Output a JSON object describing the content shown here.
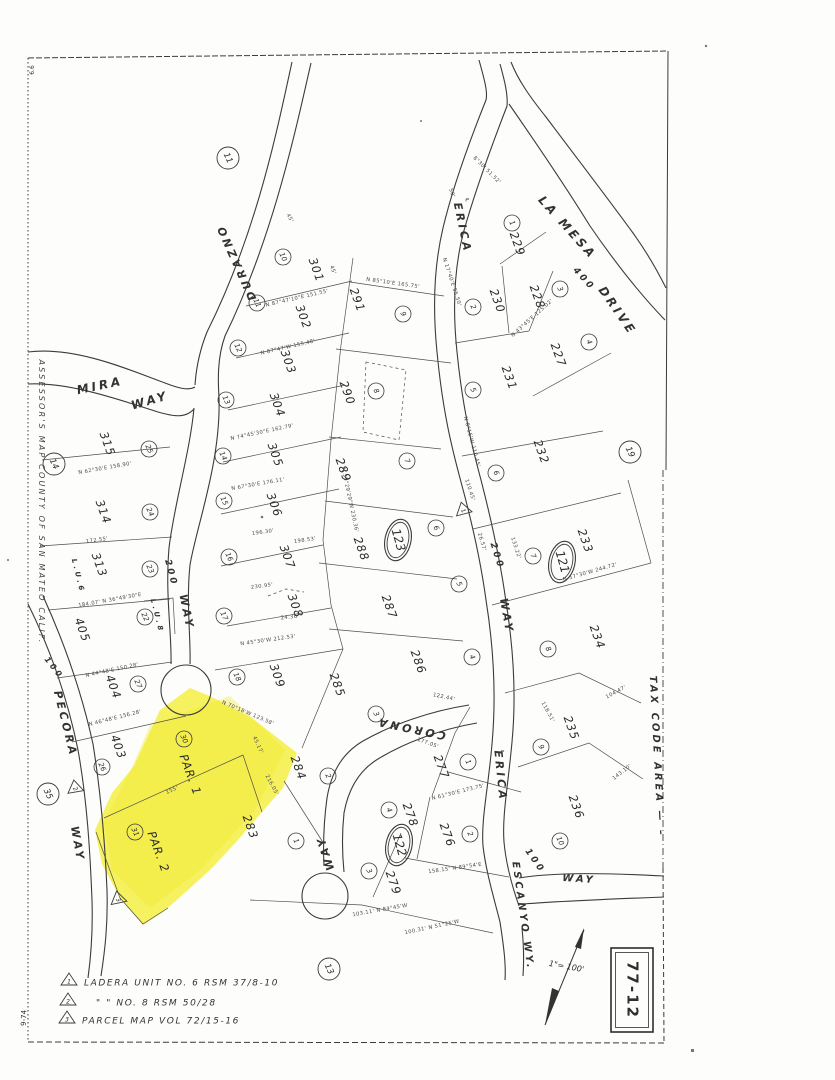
{
  "sheet": {
    "number": "77-12",
    "scale_label": "1\"= 100'",
    "side_title": "ASSESSOR'S  MAP  COUNTY  OF  SAN  MATEO  CALIF.",
    "tax_area_label": "TAX  CODE  AREA — –",
    "corner_mark_top": "6.6",
    "corner_mark_bottom": "9-74",
    "highlight_color": "#f4ee3b",
    "ink_color": "#3b3b3b"
  },
  "legend": {
    "rows": [
      {
        "sym": "1",
        "x": 69,
        "y": 983,
        "tx": 84,
        "text": "LADERA   UNIT   NO. 6   RSM   37/8-10"
      },
      {
        "sym": "2",
        "x": 68,
        "y": 1003,
        "tx": 96,
        "text": "\"          \"          NO. 8   RSM   50/28"
      },
      {
        "sym": "3",
        "x": 67,
        "y": 1021,
        "tx": 82,
        "text": "PARCEL  MAP  VOL  72/15-16"
      }
    ]
  },
  "streets": [
    {
      "t": "MIRA",
      "x": 100,
      "y": 386,
      "r": -12,
      "s": 12
    },
    {
      "t": "WAY",
      "x": 150,
      "y": 401,
      "r": -16,
      "s": 12
    },
    {
      "t": "DURAZNO",
      "x": 237,
      "y": 262,
      "r": 246,
      "s": 11
    },
    {
      "t": "200",
      "x": 171,
      "y": 573,
      "r": 75,
      "s": 9
    },
    {
      "t": "WAY",
      "x": 186,
      "y": 612,
      "r": 78,
      "s": 11
    },
    {
      "t": "LA  MESA",
      "x": 567,
      "y": 228,
      "r": 48,
      "s": 12
    },
    {
      "t": "DRIVE",
      "x": 617,
      "y": 311,
      "r": 55,
      "s": 12
    },
    {
      "t": "400",
      "x": 584,
      "y": 279,
      "r": 48,
      "s": 9
    },
    {
      "t": "ERICA",
      "x": 462,
      "y": 228,
      "r": 78,
      "s": 11
    },
    {
      "t": "200",
      "x": 497,
      "y": 556,
      "r": 72,
      "s": 9
    },
    {
      "t": "WAY",
      "x": 506,
      "y": 616,
      "r": 80,
      "s": 11
    },
    {
      "t": "ERICA",
      "x": 500,
      "y": 776,
      "r": 84,
      "s": 11
    },
    {
      "t": "100",
      "x": 535,
      "y": 861,
      "r": 55,
      "s": 9
    },
    {
      "t": "CORONA",
      "x": 411,
      "y": 728,
      "r": 192,
      "s": 11
    },
    {
      "t": "WAY",
      "x": 326,
      "y": 853,
      "r": 252,
      "s": 11
    },
    {
      "t": "ESCANYO  WY.",
      "x": 523,
      "y": 916,
      "r": 82,
      "s": 10
    },
    {
      "t": "WAY",
      "x": 579,
      "y": 879,
      "r": 4,
      "s": 10
    },
    {
      "t": "PECORA",
      "x": 65,
      "y": 724,
      "r": 76,
      "s": 11
    },
    {
      "t": "WAY",
      "x": 77,
      "y": 844,
      "r": 80,
      "s": 11
    },
    {
      "t": "100",
      "x": 54,
      "y": 668,
      "r": 52,
      "s": 8
    },
    {
      "t": "L.U.6",
      "x": 78,
      "y": 576,
      "r": 76,
      "s": 7
    },
    {
      "t": "L.U.8",
      "x": 157,
      "y": 616,
      "r": 76,
      "s": 7
    }
  ],
  "lots": [
    {
      "t": "301",
      "x": 316,
      "y": 270
    },
    {
      "t": "302",
      "x": 303,
      "y": 317
    },
    {
      "t": "303",
      "x": 288,
      "y": 362
    },
    {
      "t": "304",
      "x": 277,
      "y": 405
    },
    {
      "t": "305",
      "x": 275,
      "y": 455
    },
    {
      "t": "306",
      "x": 274,
      "y": 505
    },
    {
      "t": "307",
      "x": 287,
      "y": 557
    },
    {
      "t": "308",
      "x": 295,
      "y": 606
    },
    {
      "t": "309",
      "x": 277,
      "y": 676
    },
    {
      "t": "291",
      "x": 357,
      "y": 300
    },
    {
      "t": "290",
      "x": 347,
      "y": 393
    },
    {
      "t": "289",
      "x": 343,
      "y": 470
    },
    {
      "t": "288",
      "x": 361,
      "y": 549
    },
    {
      "t": "287",
      "x": 389,
      "y": 607
    },
    {
      "t": "286",
      "x": 418,
      "y": 662
    },
    {
      "t": "285",
      "x": 337,
      "y": 685
    },
    {
      "t": "284",
      "x": 298,
      "y": 768
    },
    {
      "t": "283",
      "x": 250,
      "y": 827
    },
    {
      "t": "277",
      "x": 441,
      "y": 767
    },
    {
      "t": "278",
      "x": 410,
      "y": 815
    },
    {
      "t": "276",
      "x": 447,
      "y": 835
    },
    {
      "t": "279",
      "x": 393,
      "y": 883
    },
    {
      "t": "229",
      "x": 517,
      "y": 244
    },
    {
      "t": "230",
      "x": 497,
      "y": 301
    },
    {
      "t": "228",
      "x": 537,
      "y": 297
    },
    {
      "t": "227",
      "x": 558,
      "y": 355
    },
    {
      "t": "231",
      "x": 509,
      "y": 378
    },
    {
      "t": "232",
      "x": 541,
      "y": 452
    },
    {
      "t": "233",
      "x": 585,
      "y": 541
    },
    {
      "t": "234",
      "x": 597,
      "y": 637
    },
    {
      "t": "235",
      "x": 571,
      "y": 728
    },
    {
      "t": "236",
      "x": 576,
      "y": 807
    },
    {
      "t": "315",
      "x": 107,
      "y": 444
    },
    {
      "t": "314",
      "x": 103,
      "y": 512
    },
    {
      "t": "313",
      "x": 99,
      "y": 565
    },
    {
      "t": "405",
      "x": 82,
      "y": 630
    },
    {
      "t": "404",
      "x": 113,
      "y": 687
    },
    {
      "t": "403",
      "x": 118,
      "y": 747
    },
    {
      "t": "PAR.  1",
      "x": 190,
      "y": 775
    },
    {
      "t": "PAR.  2",
      "x": 158,
      "y": 852
    }
  ],
  "circles": [
    {
      "n": "10",
      "x": 283,
      "y": 257
    },
    {
      "n": "11",
      "x": 257,
      "y": 303
    },
    {
      "n": "12",
      "x": 238,
      "y": 348
    },
    {
      "n": "13",
      "x": 226,
      "y": 400
    },
    {
      "n": "14",
      "x": 223,
      "y": 456
    },
    {
      "n": "15",
      "x": 224,
      "y": 501
    },
    {
      "n": "16",
      "x": 229,
      "y": 557
    },
    {
      "n": "17",
      "x": 224,
      "y": 616
    },
    {
      "n": "18",
      "x": 237,
      "y": 677
    },
    {
      "n": "9",
      "x": 403,
      "y": 314
    },
    {
      "n": "8",
      "x": 376,
      "y": 391
    },
    {
      "n": "7",
      "x": 407,
      "y": 461
    },
    {
      "n": "6",
      "x": 436,
      "y": 528
    },
    {
      "n": "5",
      "x": 459,
      "y": 584
    },
    {
      "n": "4",
      "x": 472,
      "y": 657
    },
    {
      "n": "3",
      "x": 376,
      "y": 714
    },
    {
      "n": "2",
      "x": 328,
      "y": 776
    },
    {
      "n": "1",
      "x": 296,
      "y": 841
    },
    {
      "n": "1",
      "x": 512,
      "y": 223
    },
    {
      "n": "2",
      "x": 473,
      "y": 307
    },
    {
      "n": "3",
      "x": 560,
      "y": 289
    },
    {
      "n": "4",
      "x": 589,
      "y": 342
    },
    {
      "n": "5",
      "x": 473,
      "y": 390
    },
    {
      "n": "6",
      "x": 496,
      "y": 473
    },
    {
      "n": "7",
      "x": 533,
      "y": 556
    },
    {
      "n": "8",
      "x": 548,
      "y": 649
    },
    {
      "n": "9",
      "x": 541,
      "y": 747
    },
    {
      "n": "10",
      "x": 560,
      "y": 841
    },
    {
      "n": "1",
      "x": 468,
      "y": 762
    },
    {
      "n": "2",
      "x": 470,
      "y": 834
    },
    {
      "n": "3",
      "x": 369,
      "y": 871
    },
    {
      "n": "4",
      "x": 389,
      "y": 810
    },
    {
      "n": "25",
      "x": 149,
      "y": 449
    },
    {
      "n": "24",
      "x": 150,
      "y": 512
    },
    {
      "n": "23",
      "x": 150,
      "y": 569
    },
    {
      "n": "22",
      "x": 145,
      "y": 617
    },
    {
      "n": "27",
      "x": 138,
      "y": 684
    },
    {
      "n": "26",
      "x": 102,
      "y": 767
    },
    {
      "n": "30",
      "x": 184,
      "y": 739
    },
    {
      "n": "31",
      "x": 135,
      "y": 832
    }
  ],
  "big_circles": [
    {
      "n": "11",
      "x": 228,
      "y": 158
    },
    {
      "n": "14",
      "x": 54,
      "y": 464
    },
    {
      "n": "19",
      "x": 630,
      "y": 452
    },
    {
      "n": "13",
      "x": 329,
      "y": 969
    },
    {
      "n": "35",
      "x": 48,
      "y": 794
    }
  ],
  "blocks": [
    {
      "n": "123",
      "x": 398,
      "y": 540
    },
    {
      "n": "121",
      "x": 562,
      "y": 562
    },
    {
      "n": "122",
      "x": 399,
      "y": 845
    }
  ],
  "triangles": [
    {
      "n": "1",
      "x": 463,
      "y": 509,
      "r": -15
    },
    {
      "n": "2",
      "x": 75,
      "y": 787,
      "r": -10
    },
    {
      "n": "3",
      "x": 118,
      "y": 898,
      "r": -12
    }
  ],
  "dims": [
    {
      "t": "N 85°10'E  165.75'",
      "x": 393,
      "y": 283,
      "r": 8
    },
    {
      "t": "N 87°47'10\"E  151.55'",
      "x": 297,
      "y": 298,
      "r": -13
    },
    {
      "t": "N 87°47'W  155.48'",
      "x": 288,
      "y": 347,
      "r": -13
    },
    {
      "t": "45'",
      "x": 333,
      "y": 270,
      "r": 70
    },
    {
      "t": "45'",
      "x": 290,
      "y": 218,
      "r": 62
    },
    {
      "t": "50'",
      "x": 452,
      "y": 193,
      "r": 70
    },
    {
      "t": "N 74°45'30\"E  162.79'",
      "x": 262,
      "y": 432,
      "r": -12
    },
    {
      "t": "N 67°30'E  176.11'",
      "x": 258,
      "y": 484,
      "r": -10
    },
    {
      "t": "196.30'",
      "x": 263,
      "y": 532,
      "r": -8
    },
    {
      "t": "198.53'",
      "x": 305,
      "y": 540,
      "r": -8
    },
    {
      "t": "230.95'",
      "x": 262,
      "y": 586,
      "r": -7
    },
    {
      "t": "N 45°30'W  212.53'",
      "x": 268,
      "y": 640,
      "r": -8
    },
    {
      "t": "24.36'",
      "x": 290,
      "y": 617,
      "r": -6
    },
    {
      "t": "N 62°30'E  158.90'",
      "x": 105,
      "y": 468,
      "r": -10
    },
    {
      "t": "172.55'",
      "x": 97,
      "y": 540,
      "r": -8
    },
    {
      "t": "184.07'  N 36°49'30\"E",
      "x": 110,
      "y": 600,
      "r": -10
    },
    {
      "t": "N 44°48'E  150.28'",
      "x": 112,
      "y": 670,
      "r": -12
    },
    {
      "t": "N 46°48'E  156.28'",
      "x": 115,
      "y": 718,
      "r": -14
    },
    {
      "t": "N 70°18'W  123.58'",
      "x": 248,
      "y": 713,
      "r": 23
    },
    {
      "t": "155'",
      "x": 172,
      "y": 790,
      "r": -24
    },
    {
      "t": "216.05'",
      "x": 272,
      "y": 785,
      "r": 62
    },
    {
      "t": "45.17'",
      "x": 258,
      "y": 745,
      "r": 65
    },
    {
      "t": "N 57°30'W  244.72'",
      "x": 590,
      "y": 572,
      "r": -16
    },
    {
      "t": "104.47'",
      "x": 616,
      "y": 692,
      "r": -28
    },
    {
      "t": "143.10'",
      "x": 622,
      "y": 772,
      "r": -38
    },
    {
      "t": "122.44'",
      "x": 444,
      "y": 697,
      "r": 12
    },
    {
      "t": "177.05'",
      "x": 428,
      "y": 743,
      "r": 20
    },
    {
      "t": "N 61°30'E  173.75'",
      "x": 458,
      "y": 792,
      "r": -14
    },
    {
      "t": "158.15'  N 89°54'E",
      "x": 455,
      "y": 868,
      "r": -8
    },
    {
      "t": "103.11'  N 84°45'W",
      "x": 380,
      "y": 910,
      "r": -10
    },
    {
      "t": "100.31'  N 51°25'W",
      "x": 432,
      "y": 927,
      "r": -12
    },
    {
      "t": "N 39°29'29\"W  230.36'",
      "x": 350,
      "y": 500,
      "r": 78
    },
    {
      "t": "110.45'",
      "x": 470,
      "y": 490,
      "r": 72
    },
    {
      "t": "26.57'",
      "x": 482,
      "y": 542,
      "r": 74
    },
    {
      "t": "133.22'",
      "x": 516,
      "y": 548,
      "r": 72
    },
    {
      "t": "N 43°45'E  125.02'",
      "x": 532,
      "y": 318,
      "r": -42
    },
    {
      "t": "N 17°40'E  95.50'",
      "x": 452,
      "y": 282,
      "r": 72
    },
    {
      "t": "8°30'  51.52'",
      "x": 487,
      "y": 170,
      "r": 45
    },
    {
      "t": "N 8°15'W  110.45'",
      "x": 472,
      "y": 442,
      "r": 75
    },
    {
      "t": "118.51'",
      "x": 548,
      "y": 712,
      "r": 62
    },
    {
      "t": "℄",
      "x": 467,
      "y": 200,
      "r": 75
    },
    {
      "t": "℄",
      "x": 502,
      "y": 752,
      "r": 80
    }
  ]
}
